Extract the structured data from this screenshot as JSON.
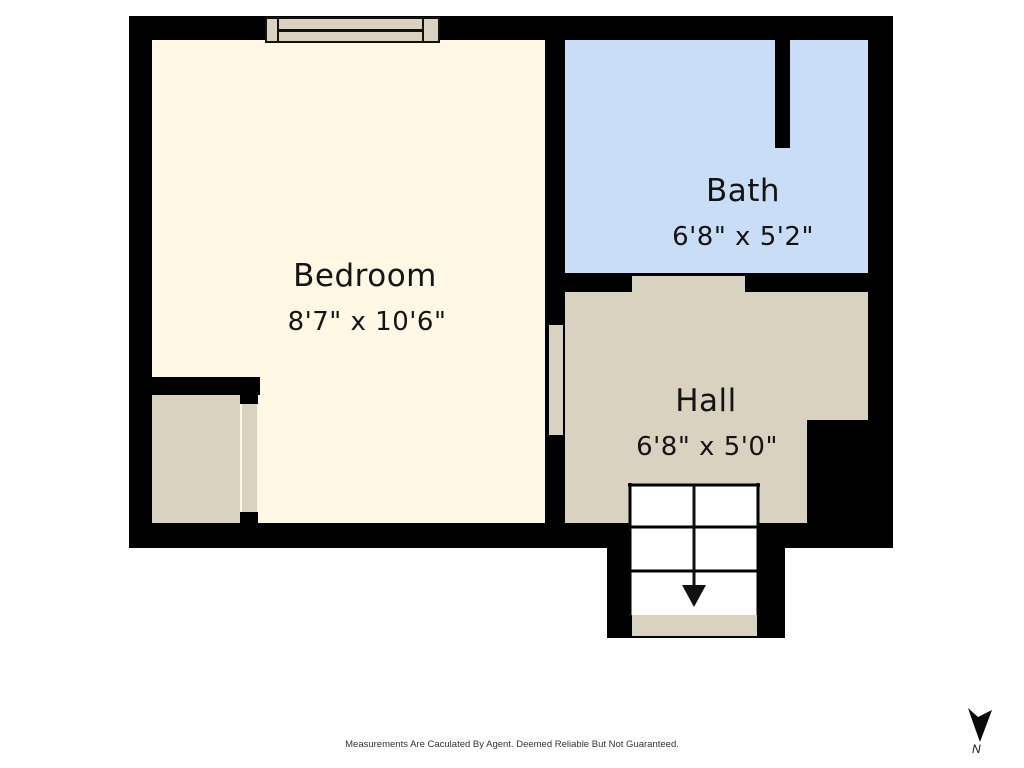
{
  "plan": {
    "rooms": [
      {
        "id": "bedroom",
        "name": "Bedroom",
        "dimensions": "8'7\" x 10'6\"",
        "floor_color": "#FEF8E4"
      },
      {
        "id": "bath",
        "name": "Bath",
        "dimensions": "6'8\" x 5'2\"",
        "floor_color": "#C9DDF6"
      },
      {
        "id": "hall",
        "name": "Hall",
        "dimensions": "6'8\" x 5'0\"",
        "floor_color": "#D9D2C0"
      }
    ],
    "wall_color": "#000000",
    "accent_tan": "#D9D2C0",
    "stairs": {
      "direction": "down",
      "rows": 3,
      "columns": 2
    }
  },
  "compass": {
    "label": "N"
  },
  "footer": {
    "disclaimer": "Measurements Are Caculated By Agent. Deemed Reliable But Not Guaranteed."
  }
}
